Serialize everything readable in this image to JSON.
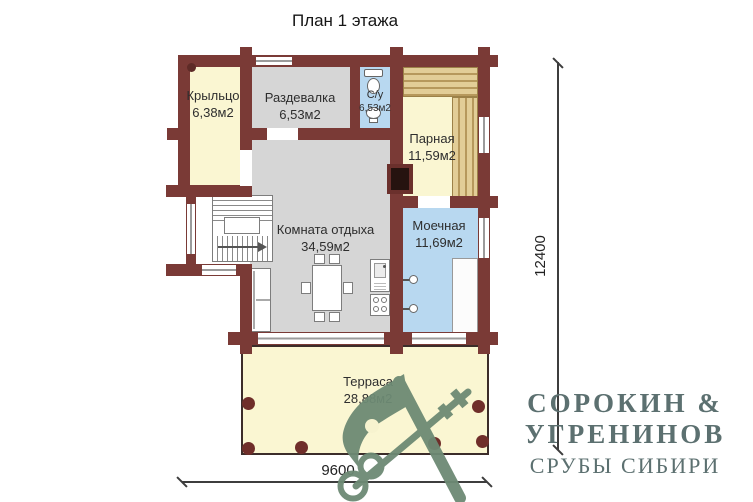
{
  "title": "План 1 этажа",
  "rooms": [
    {
      "id": "porch",
      "name": "Крыльцо",
      "area": "6,38м2"
    },
    {
      "id": "changing",
      "name": "Раздевалка",
      "area": "6,53м2"
    },
    {
      "id": "wc",
      "name": "С/у",
      "area": "6,53м2"
    },
    {
      "id": "steam",
      "name": "Парная",
      "area": "11,59м2"
    },
    {
      "id": "lounge",
      "name": "Комната отдыха",
      "area": "34,59м2"
    },
    {
      "id": "washing",
      "name": "Моечная",
      "area": "11,69м2"
    },
    {
      "id": "terrace",
      "name": "Терраса",
      "area": "28,88м2"
    }
  ],
  "dimensions": {
    "vertical": "12400",
    "horizontal": "9600"
  },
  "logo": {
    "line1": "СОРОКИН &",
    "line2": "УГРЕНИНОВ",
    "line3": "СРУБЫ СИБИРИ"
  },
  "colors": {
    "wall": "#7a3a36",
    "floor_yellow": "#faf6d2",
    "floor_gray": "#d6d6d6",
    "floor_blue": "#b8d8f0",
    "bench_wood": "#dcc189",
    "terrace_column": "#6f2e2a",
    "logo_green": "#6d8a74",
    "logo_text": "#5c7070"
  }
}
